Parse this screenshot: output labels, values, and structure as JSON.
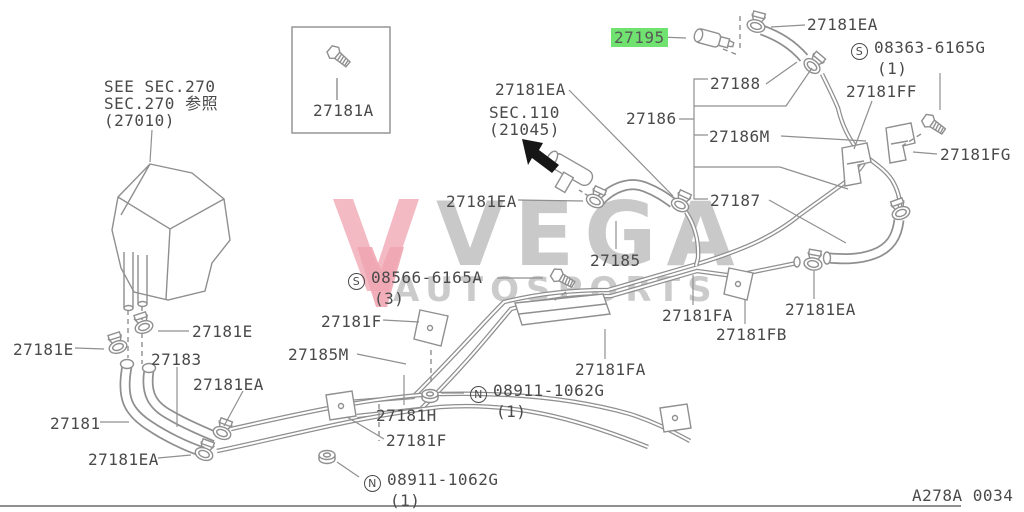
{
  "colors": {
    "background": "#ffffff",
    "line": "#8f8f8f",
    "label_text": "#4a4a4a",
    "highlight_green": "#6fe26f",
    "watermark_gray": "#c9c9c9",
    "watermark_pink": "#f2aeb9",
    "arrow_black": "#161616"
  },
  "watermark": {
    "word": "VEGA",
    "subword": "AUTOSPORTS",
    "logo": "double-v-mark"
  },
  "diagram_code": "A278A 0034",
  "labels": [
    {
      "name": "ref-note-sec270",
      "lines": [
        "SEE SEC.270",
        "SEC.270 参照",
        "(27010)"
      ],
      "x": 104,
      "y": 78
    },
    {
      "name": "part-27181A",
      "text": "27181A",
      "x": 313,
      "y": 102
    },
    {
      "name": "part-27195",
      "text": "27195",
      "x": 611,
      "y": 29,
      "highlight": true
    },
    {
      "name": "part-27181EA-top",
      "text": "27181EA",
      "x": 807,
      "y": 16
    },
    {
      "name": "part-08363-6165G",
      "circled": "S",
      "text": "08363-6165G",
      "qty": "(1)",
      "x": 851,
      "y": 39
    },
    {
      "name": "part-27188",
      "text": "27188",
      "x": 710,
      "y": 75
    },
    {
      "name": "part-27181FF",
      "text": "27181FF",
      "x": 846,
      "y": 83
    },
    {
      "name": "part-27186",
      "text": "27186",
      "x": 626,
      "y": 110
    },
    {
      "name": "part-27186M",
      "text": "27186M",
      "x": 709,
      "y": 128
    },
    {
      "name": "part-27181FG",
      "text": "27181FG",
      "x": 940,
      "y": 146
    },
    {
      "name": "part-27187",
      "text": "27187",
      "x": 710,
      "y": 192
    },
    {
      "name": "part-27181EA-hose-upper",
      "text": "27181EA",
      "x": 495,
      "y": 81
    },
    {
      "name": "ref-note-sec110",
      "lines": [
        "SEC.110",
        "(21045)"
      ],
      "x": 489,
      "y": 104
    },
    {
      "name": "part-27181EA-hose-left",
      "text": "27181EA",
      "x": 446,
      "y": 193
    },
    {
      "name": "part-27185",
      "text": "27185",
      "x": 590,
      "y": 252
    },
    {
      "name": "part-08566-6165A",
      "circled": "S",
      "text": "08566-6165A",
      "qty": "(3)",
      "x": 348,
      "y": 269
    },
    {
      "name": "part-27181F-upper",
      "text": "27181F",
      "x": 321,
      "y": 313
    },
    {
      "name": "part-27185M",
      "text": "27185M",
      "x": 288,
      "y": 346
    },
    {
      "name": "part-27181E-right",
      "text": "27181E",
      "x": 192,
      "y": 323
    },
    {
      "name": "part-27181E-left",
      "text": "27181E",
      "x": 13,
      "y": 341
    },
    {
      "name": "part-27183",
      "text": "27183",
      "x": 151,
      "y": 351
    },
    {
      "name": "part-27181EA-elbow-upper",
      "text": "27181EA",
      "x": 193,
      "y": 376
    },
    {
      "name": "part-27181",
      "text": "27181",
      "x": 50,
      "y": 415
    },
    {
      "name": "part-27181EA-elbow-lower",
      "text": "27181EA",
      "x": 88,
      "y": 451
    },
    {
      "name": "part-27181H",
      "text": "27181H",
      "x": 376,
      "y": 407
    },
    {
      "name": "part-27181F-lower",
      "text": "27181F",
      "x": 386,
      "y": 432
    },
    {
      "name": "part-08911-1062G-right",
      "circled": "N",
      "text": "08911-1062G",
      "qty": "(1)",
      "x": 470,
      "y": 382
    },
    {
      "name": "part-08911-1062G-bottom",
      "circled": "N",
      "text": "08911-1062G",
      "qty": "(1)",
      "x": 364,
      "y": 471
    },
    {
      "name": "part-27181FA-upper",
      "text": "27181FA",
      "x": 662,
      "y": 307
    },
    {
      "name": "part-27181FB",
      "text": "27181FB",
      "x": 716,
      "y": 326
    },
    {
      "name": "part-27181EA-right",
      "text": "27181EA",
      "x": 785,
      "y": 301
    },
    {
      "name": "part-27181FA-lower",
      "text": "27181FA",
      "x": 575,
      "y": 361
    },
    {
      "name": "diagram-code",
      "text": "A278A 0034",
      "x": 912,
      "y": 487
    }
  ]
}
